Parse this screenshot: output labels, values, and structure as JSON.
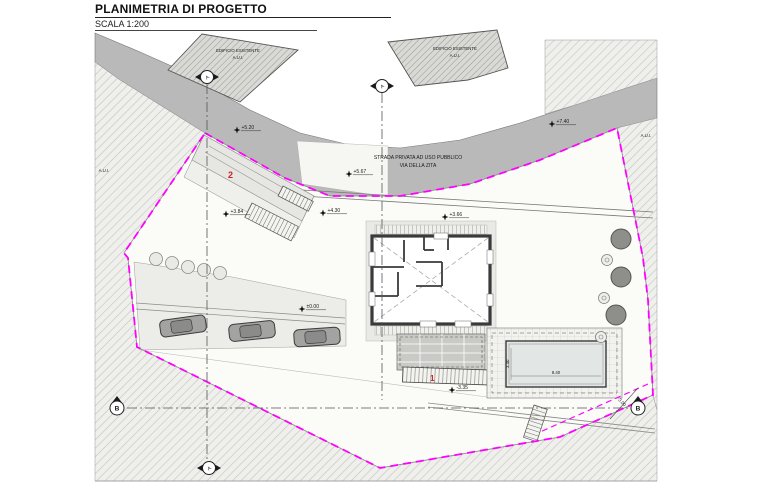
{
  "header": {
    "title": "PLANIMETRIA DI PROGETTO",
    "scale": "SCALA 1:200"
  },
  "buildings": {
    "left": {
      "line1": "EDIFICIO ESISTENTE",
      "line2": "A.U.I."
    },
    "right": {
      "line1": "EDIFICIO ESISTENTE",
      "line2": "A.U.I."
    }
  },
  "road": {
    "line1": "STRADA PRIVATA AD USO PUBBLICO",
    "line2": "VIA DELLA ZITA"
  },
  "parcels": {
    "right_label": "A.U.I.",
    "left_label": "A.U.I."
  },
  "elevations": [
    {
      "label": "+5.20"
    },
    {
      "label": "+5.67"
    },
    {
      "label": "+7.40"
    },
    {
      "label": "+3.84"
    },
    {
      "label": "+4.30"
    },
    {
      "label": "+3.66"
    },
    {
      "label": "±0.00"
    },
    {
      "label": "-3.35"
    }
  ],
  "dimensions": {
    "pool_length": "8.40",
    "pool_width": "3.40",
    "setback_distance": "3.00"
  },
  "markers": {
    "section_a": "A",
    "section_b": "B"
  },
  "annotations": {
    "ramp_number": "2",
    "stair_number": "1"
  },
  "colors": {
    "boundary": "#ff00ff",
    "road": "#b9b9b9",
    "annotation_red": "#cc2222",
    "wall": "#3a3a3a",
    "hatch_line": "#c2c2be"
  }
}
